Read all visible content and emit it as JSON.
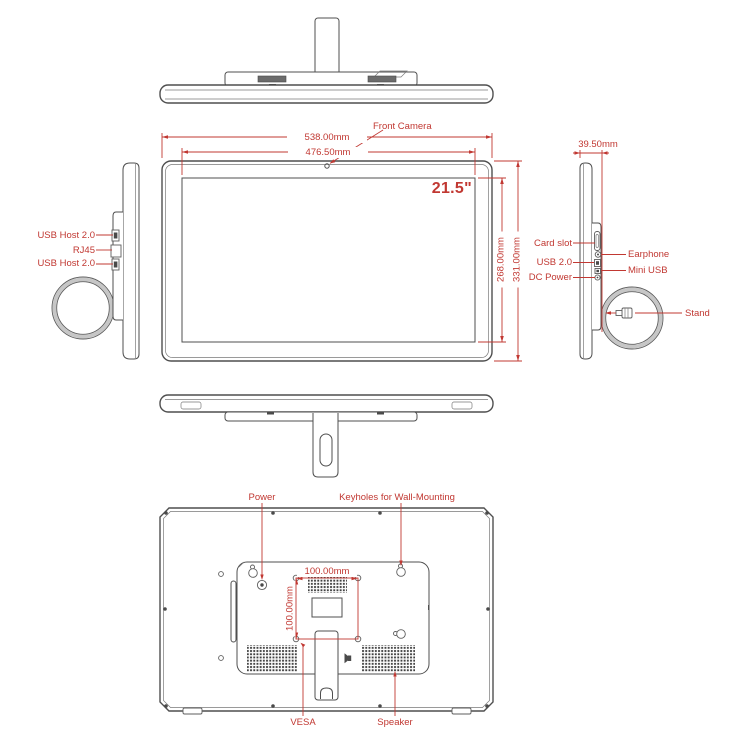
{
  "colors": {
    "annotation": "#c13832",
    "line": "#4f4f4f"
  },
  "front_view": {
    "camera_label": "Front Camera",
    "screen_size": "21.5\"",
    "dim_outer_width": "538.00mm",
    "dim_screen_width": "476.50mm",
    "dim_screen_height": "268.00mm",
    "dim_outer_height": "331.00mm"
  },
  "left_side_view": {
    "usb_host_top": "USB Host 2.0",
    "rj45": "RJ45",
    "usb_host_bottom": "USB Host 2.0"
  },
  "right_side_view": {
    "dim_depth": "39.50mm",
    "card_slot": "Card slot",
    "earphone": "Earphone",
    "usb": "USB 2.0",
    "mini_usb": "Mini USB",
    "dc_power": "DC Power",
    "stand": "Stand"
  },
  "back_view": {
    "power": "Power",
    "keyholes": "Keyholes for Wall-Mounting",
    "vesa_width": "100.00mm",
    "vesa_height": "100.00mm",
    "vesa": "VESA",
    "speaker": "Speaker"
  }
}
